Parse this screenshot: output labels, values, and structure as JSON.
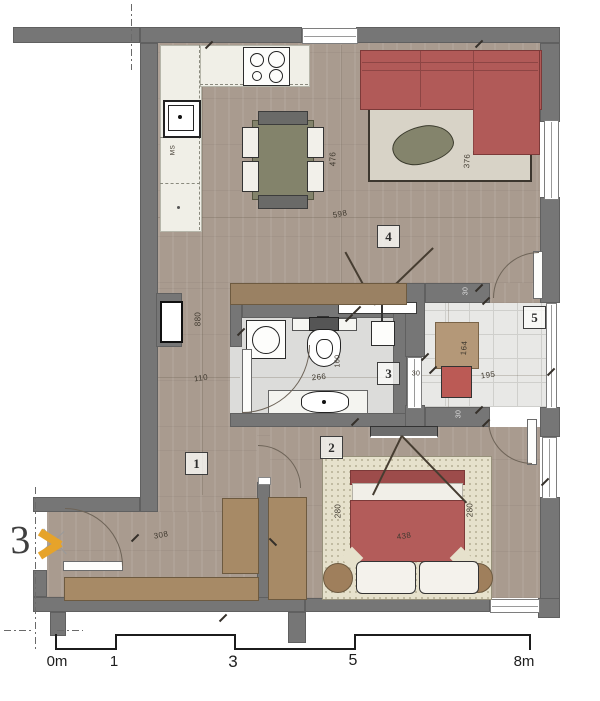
{
  "annotation": {
    "sheet_number": "3"
  },
  "room_numbers": {
    "r1": "1",
    "r2": "2",
    "r3": "3",
    "r4": "4",
    "r5": "5"
  },
  "dimensions": {
    "dining": "476",
    "living_width": "598",
    "living_rug": "376",
    "hall_length": "880",
    "hall_width": "110",
    "bath_width": "266",
    "bath_depth": "160",
    "entry_width": "308",
    "bed_width": "438",
    "bed_left": "280",
    "bed_right": "280",
    "balcony_table": "164",
    "balcony_width": "195",
    "wall_top": "30",
    "wall_mid": "30",
    "wall_bottom": "30",
    "kitchen_appliance": "MS"
  },
  "scale_bar": {
    "zero": "0m",
    "one": "1",
    "three": "3",
    "five": "5",
    "eight": "8m"
  },
  "colors": {
    "wall": "#767676",
    "wood": "#a99b8f",
    "bath_floor": "#dcdcda",
    "balcony_floor": "#e8e8e6",
    "sofa_red": "#b15a58",
    "bed_red": "#b35c5a",
    "olive": "#83836b",
    "rug_living": "#d8d3c7",
    "rug_bed": "#e6e1cc",
    "wood_furniture": "#a78a66",
    "counter": "#f0efe7",
    "marker_orange": "#e6a32a"
  }
}
